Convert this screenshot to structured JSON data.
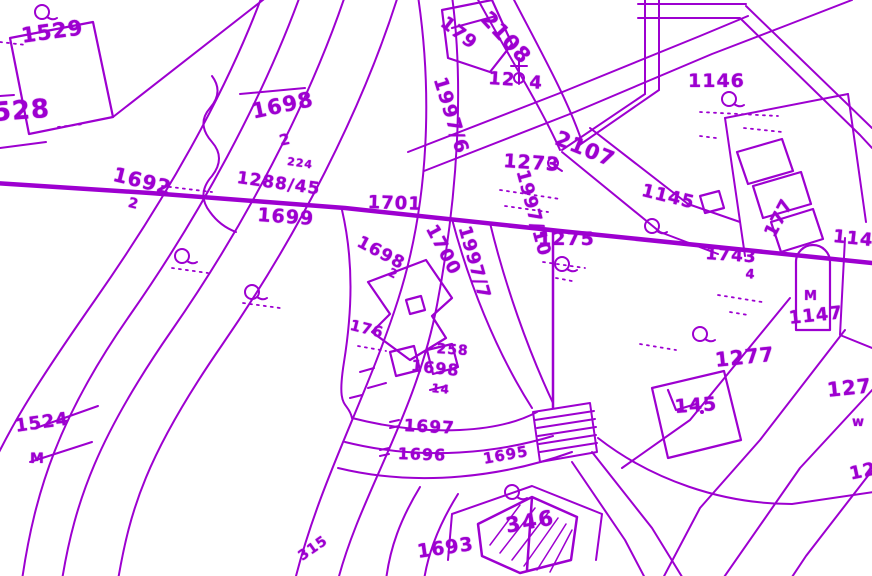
{
  "map": {
    "type": "cadastral-parcel-map",
    "colors": {
      "ink": "#9d00d0",
      "background": "#ffffff"
    },
    "labels": {
      "l1529": "1529",
      "l528": "528",
      "l1692": "1692",
      "l1692s": "2",
      "l1698a": "1698",
      "l1698as": "2",
      "l224": "224",
      "l1288": "1288/45",
      "l1699": "1699",
      "l1701": "1701",
      "l1700": "1700",
      "l1997_6": "1997/6",
      "l1997_7": "1997/7",
      "l1997_10": "1997/10",
      "l1698b": "1698",
      "l1698bs": "2",
      "l176": "176",
      "l258": "258",
      "l1698c": "1698",
      "l1698cs": "14",
      "l1697": "1697",
      "l1696": "1696",
      "l1695": "1695",
      "l1693": "1693",
      "l315": "315",
      "l1524": "1524",
      "l1524s": "M",
      "l179": "179",
      "l2108": "2108",
      "l1274a": "12",
      "l1274b": "4",
      "l1146": "1146",
      "l2107": "2107",
      "l1273": "1273",
      "l1145": "1145",
      "l177": "177",
      "l1144": "1144",
      "l1743": "1743",
      "l1743s": "4",
      "l1147": "1147",
      "lshrineM": "M",
      "l1277": "1277",
      "l145": "145",
      "l1278": "1278",
      "l1278s": "w",
      "l12cut": "12",
      "l1275": "1275",
      "l346": "346"
    },
    "symbols": {
      "tree_symbol": "circle-with-flag map glyph",
      "cross_symbol": "cross on staff glyph",
      "shrine_symbol": "arch-top monument outline",
      "bridge_hatch": "striped rectangle over road",
      "building_hatch": "diagonally hatched building footprint"
    }
  }
}
